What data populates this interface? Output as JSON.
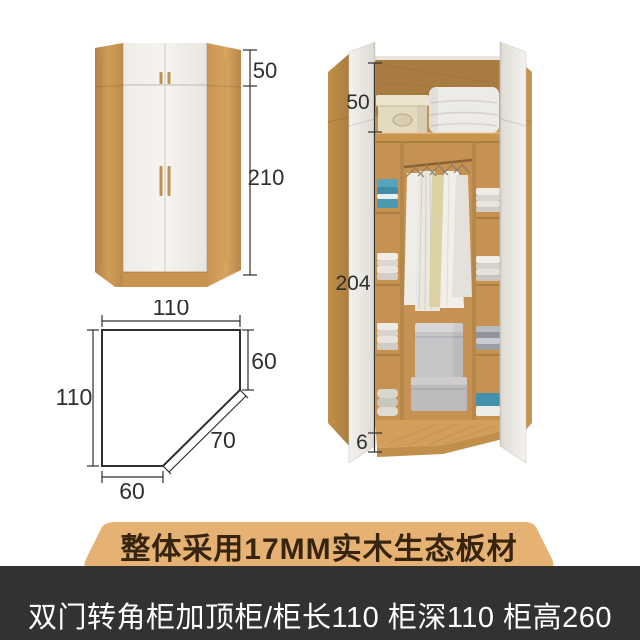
{
  "banners": {
    "material": "整体采用17MM实木生态板材",
    "spec": "双门转角柜加顶柜/柜长110 柜深110 柜高260"
  },
  "closed_view": {
    "top_cabinet_height": "50",
    "body_height": "210"
  },
  "floor_plan": {
    "top_width": "110",
    "right_depth": "60",
    "diagonal_width": "70",
    "bottom_width": "60",
    "left_depth": "110"
  },
  "open_view": {
    "top_section_height": "50",
    "interior_height": "204",
    "base_height": "6"
  },
  "colors": {
    "wood": "#c9924e",
    "door_white": "#f1efea",
    "banner_bg": "#e6b274",
    "banner_text": "#36240f",
    "footer_bg": "#343231",
    "footer_text": "#ffffff",
    "dimension_ink": "#2f2f2f",
    "towel_blue": "#4796b2"
  }
}
